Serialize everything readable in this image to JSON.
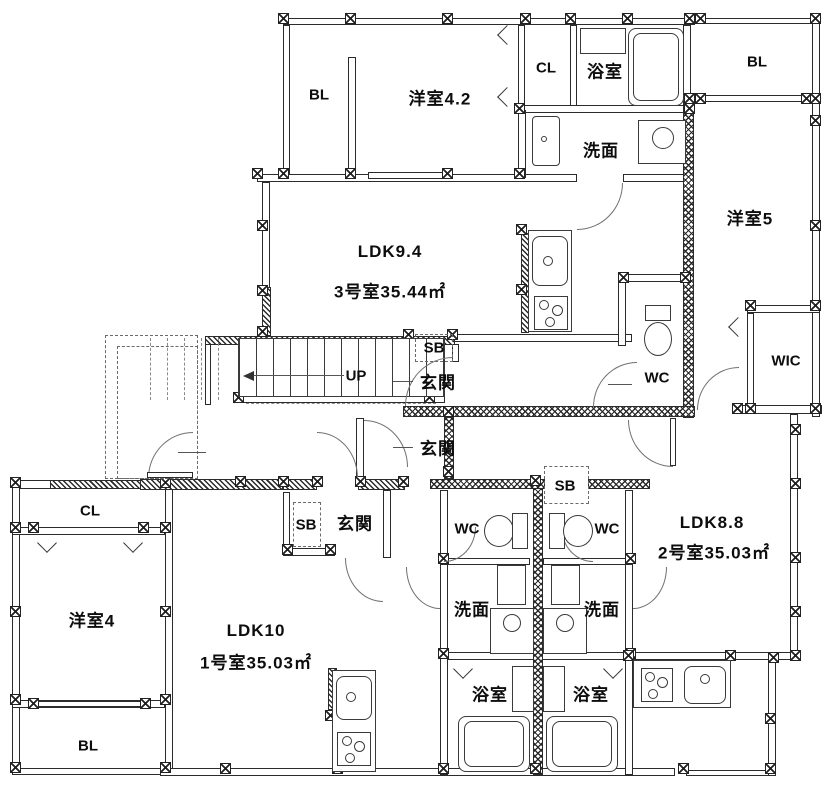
{
  "floor_plan": {
    "type": "apartment-floor-plan",
    "background_color": "#ffffff",
    "line_color": "#2b2b2b",
    "labels": [
      {
        "id": "bl-north",
        "text": "BL"
      },
      {
        "id": "yoshitsu-4-2",
        "text": "洋室4.2"
      },
      {
        "id": "cl-north",
        "text": "CL"
      },
      {
        "id": "yokushitsu-north",
        "text": "浴室"
      },
      {
        "id": "bl-northeast",
        "text": "BL"
      },
      {
        "id": "senmen-north",
        "text": "洗面"
      },
      {
        "id": "yoshitsu-5",
        "text": "洋室5"
      },
      {
        "id": "ldk-9-4",
        "text": "LDK9.4"
      },
      {
        "id": "unit3-area",
        "text": "3号室35.44㎡"
      },
      {
        "id": "sb-unit3",
        "text": "SB"
      },
      {
        "id": "genkan-unit3",
        "text": "玄関"
      },
      {
        "id": "wc-unit3",
        "text": "WC"
      },
      {
        "id": "wic",
        "text": "WIC"
      },
      {
        "id": "stairs-up",
        "text": "UP"
      },
      {
        "id": "genkan-unit2",
        "text": "玄関"
      },
      {
        "id": "cl-west",
        "text": "CL"
      },
      {
        "id": "sb-unit1",
        "text": "SB"
      },
      {
        "id": "genkan-unit1",
        "text": "玄関"
      },
      {
        "id": "sb-unit2",
        "text": "SB"
      },
      {
        "id": "wc-unit1",
        "text": "WC"
      },
      {
        "id": "wc-unit2",
        "text": "WC"
      },
      {
        "id": "ldk-8-8",
        "text": "LDK8.8"
      },
      {
        "id": "unit2-area",
        "text": "2号室35.03㎡"
      },
      {
        "id": "yoshitsu-4",
        "text": "洋室4"
      },
      {
        "id": "ldk-10",
        "text": "LDK10"
      },
      {
        "id": "unit1-area",
        "text": "1号室35.03㎡"
      },
      {
        "id": "senmen-unit1",
        "text": "洗面"
      },
      {
        "id": "senmen-unit2",
        "text": "洗面"
      },
      {
        "id": "yokushitsu-unit1",
        "text": "浴室"
      },
      {
        "id": "yokushitsu-unit2",
        "text": "浴室"
      },
      {
        "id": "bl-southwest",
        "text": "BL"
      }
    ]
  }
}
